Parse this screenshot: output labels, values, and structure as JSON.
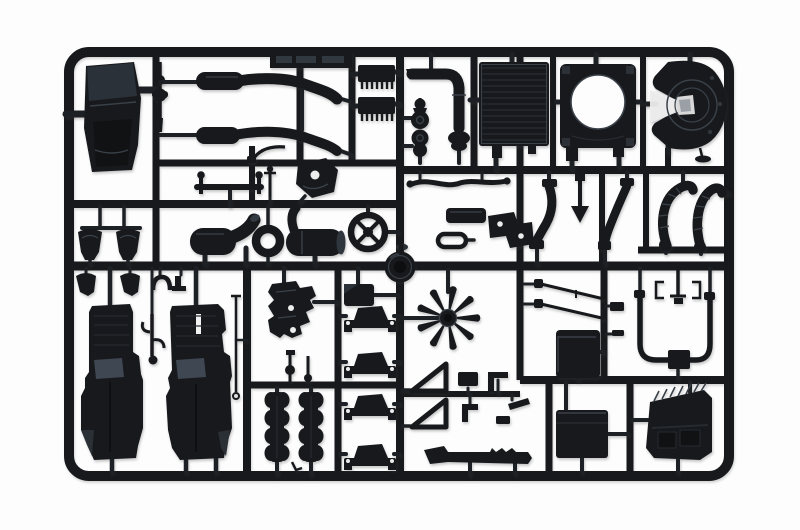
{
  "scene": {
    "type": "photograph",
    "description": "Black injection-molded plastic model-kit sprue (parts tree) of truck components, photographed on a white background",
    "background": "white",
    "object": "model kit sprue with runner frame and attached parts",
    "plastic_finish": "matte black with faint blue-grey sheen highlights"
  },
  "colors": {
    "plastic": "#17191c",
    "plastic_mid": "#262b30",
    "plastic_light": "#3a4149",
    "plastic_sheen": "#46505c",
    "runner": "#1d2024",
    "hole": "#ededed",
    "background": "#fdfdfd",
    "dark": "#0d0e10"
  },
  "parts": [
    {
      "id": "cab-roof-deflector",
      "label": "cab roof air deflector panel"
    },
    {
      "id": "universal-joint",
      "label": "small universal joint shaft"
    },
    {
      "id": "exhaust-pipe-upper",
      "label": "long exhaust pipe, upper"
    },
    {
      "id": "exhaust-pipe-lower",
      "label": "long exhaust pipe, lower"
    },
    {
      "id": "sprue-label-tag",
      "label": "molded sprue label tag (text illegible)"
    },
    {
      "id": "finned-cooler-1",
      "label": "finned cooler / heat-sink part"
    },
    {
      "id": "finned-cooler-2",
      "label": "finned cooler / heat-sink part"
    },
    {
      "id": "exhaust-elbow",
      "label": "exhaust elbow pipe with flange"
    },
    {
      "id": "pulley-1",
      "label": "small belt pulley stack"
    },
    {
      "id": "pulley-2",
      "label": "small belt pulley stack"
    },
    {
      "id": "radiator-core",
      "label": "ribbed radiator core"
    },
    {
      "id": "fan-shroud",
      "label": "square fan shroud with round opening"
    },
    {
      "id": "fifth-wheel",
      "label": "fifth-wheel trailer coupling plate with release pin"
    },
    {
      "id": "grab-handle",
      "label": "grab handle with ball-top posts"
    },
    {
      "id": "wiper-lever",
      "label": "small curved lever"
    },
    {
      "id": "gear-linkage",
      "label": "forked gear linkage"
    },
    {
      "id": "gearbox-cover",
      "label": "gearbox cover with hole"
    },
    {
      "id": "spoked-ring",
      "label": "spoked ring / fan clutch wheel"
    },
    {
      "id": "intake-elbow",
      "label": "air intake elbow duct"
    },
    {
      "id": "seal-ring",
      "label": "thick seal ring"
    },
    {
      "id": "muffler",
      "label": "muffler cylinder with riser pipe"
    },
    {
      "id": "wavy-hose",
      "label": "thin wavy hose"
    },
    {
      "id": "junction-box",
      "label": "small junction box"
    },
    {
      "id": "capsule-gasket",
      "label": "oval gasket part"
    },
    {
      "id": "step-bracket",
      "label": "angled step bracket with bolt holes"
    },
    {
      "id": "fender-stay-left",
      "label": "curved fender stay"
    },
    {
      "id": "arrow-bracket",
      "label": "arrow-head hanger bracket"
    },
    {
      "id": "fender-stay-right",
      "label": "curved fender stay blade"
    },
    {
      "id": "corrugated-hoses",
      "label": "pair of corrugated flexible hoses"
    },
    {
      "id": "wheel-hub",
      "label": "large round wheel hub"
    },
    {
      "id": "mudguard-brackets",
      "label": "pair of mudguard hanger brackets"
    },
    {
      "id": "pipe-clamps",
      "label": "row of small pipe clamps"
    },
    {
      "id": "engine-block-left",
      "label": "engine block half, left"
    },
    {
      "id": "engine-block-right",
      "label": "engine block half, right"
    },
    {
      "id": "pedal-linkage",
      "label": "pedal linkage between blocks"
    },
    {
      "id": "brake-rod",
      "label": "long thin brake rod"
    },
    {
      "id": "pump-manifold",
      "label": "water pump / manifold cluster"
    },
    {
      "id": "air-cleaner",
      "label": "air cleaner box"
    },
    {
      "id": "engine-mounts",
      "label": "four stacked engine mount brackets"
    },
    {
      "id": "cylinder-banks",
      "label": "two cylinder head banks"
    },
    {
      "id": "radiator-fan",
      "label": "nine-blade radiator fan"
    },
    {
      "id": "triangle-gussets",
      "label": "two hollow triangular gussets"
    },
    {
      "id": "bracket-set",
      "label": "set of small chassis brackets"
    },
    {
      "id": "running-board",
      "label": "chassis step rail"
    },
    {
      "id": "tie-rods",
      "label": "pair of thin tie rods"
    },
    {
      "id": "equipment-box",
      "label": "square equipment box"
    },
    {
      "id": "u-pipe",
      "label": "large U-shaped pipe with center block"
    },
    {
      "id": "pipe-hanger",
      "label": "thin pipe hanger bracket"
    },
    {
      "id": "battery-box",
      "label": "battery box"
    },
    {
      "id": "ribbed-cover",
      "label": "ribbed battery cover / step"
    }
  ]
}
